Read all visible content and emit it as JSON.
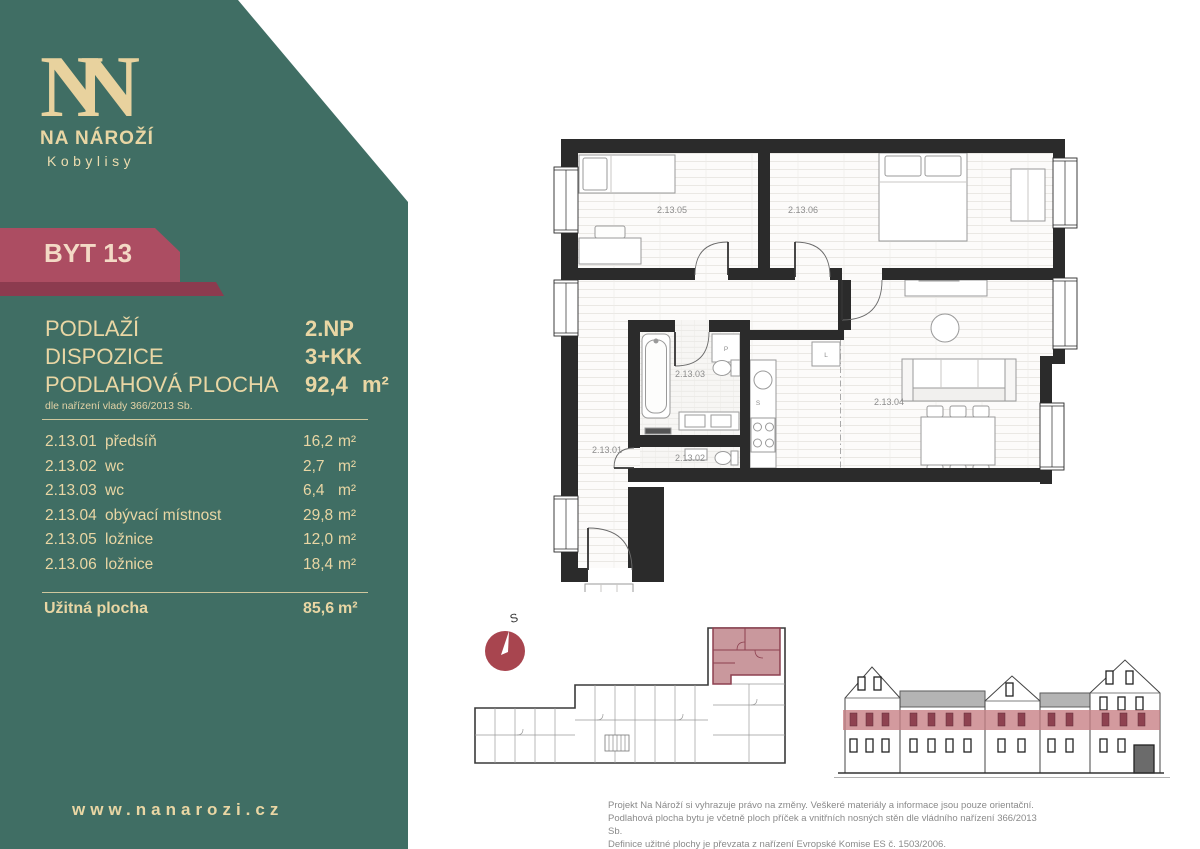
{
  "brand": {
    "logo": "NN",
    "name": "NA NÁROŽÍ",
    "location": "Kobylisy",
    "website": "www.nanarozi.cz"
  },
  "unit": {
    "badge": "BYT 13"
  },
  "summary": {
    "rows": [
      {
        "label": "PODLAŽÍ",
        "value": "2.NP"
      },
      {
        "label": "DISPOZICE",
        "value": "3+KK"
      },
      {
        "label": "PODLAHOVÁ PLOCHA",
        "value": "92,4",
        "unit": "m²"
      }
    ],
    "note": "dle nařízení vlady 366/2013 Sb."
  },
  "rooms": {
    "items": [
      {
        "code": "2.13.01",
        "name": "předsíň",
        "value": "16,2",
        "unit": "m²"
      },
      {
        "code": "2.13.02",
        "name": "wc",
        "value": "2,7",
        "unit": "m²"
      },
      {
        "code": "2.13.03",
        "name": "wc",
        "value": "6,4",
        "unit": "m²"
      },
      {
        "code": "2.13.04",
        "name": "obývací místnost",
        "value": "29,8",
        "unit": "m²"
      },
      {
        "code": "2.13.05",
        "name": "ložnice",
        "value": "12,0",
        "unit": "m²"
      },
      {
        "code": "2.13.06",
        "name": "ložnice",
        "value": "18,4",
        "unit": "m²"
      }
    ],
    "total_label": "Užitná plocha",
    "total_value": "85,6",
    "total_unit": "m²"
  },
  "plan": {
    "rooms": {
      "r01": "2.13.01",
      "r02": "2.13.02",
      "r03": "2.13.03",
      "r04": "2.13.04",
      "r05": "2.13.05",
      "r06": "2.13.06"
    },
    "fixtures": {
      "washer": "P",
      "fridge": "L",
      "sink": "S"
    }
  },
  "compass": {
    "north_label": "S"
  },
  "disclaimer": {
    "line1": "Projekt Na Nároží si vyhrazuje právo na změny. Veškeré materiály a informace jsou pouze orientační.",
    "line2": "Podlahová plocha bytu je včetně ploch příček a vnitřních nosných stěn dle vládního nařízení 366/2013 Sb.",
    "line3": "Definice užitné plochy je převzata z nařízení Evropské Komise ES č. 1503/2006."
  },
  "colors": {
    "sidebar_green": "#406E64",
    "cream": "#E9D6A4",
    "ribbon": "#AC4D62",
    "ribbon_dark": "#8C3B4F",
    "ribbon_text": "#F3D9C5",
    "wall": "#2B2B2B",
    "compass_red": "#A8454F",
    "highlight_fill": "#C9989D",
    "highlight_stroke": "#8D4150",
    "elevation_band": "#C67D83",
    "roof_gray": "#B4B4B4",
    "text_gray": "#8A8A8A"
  }
}
